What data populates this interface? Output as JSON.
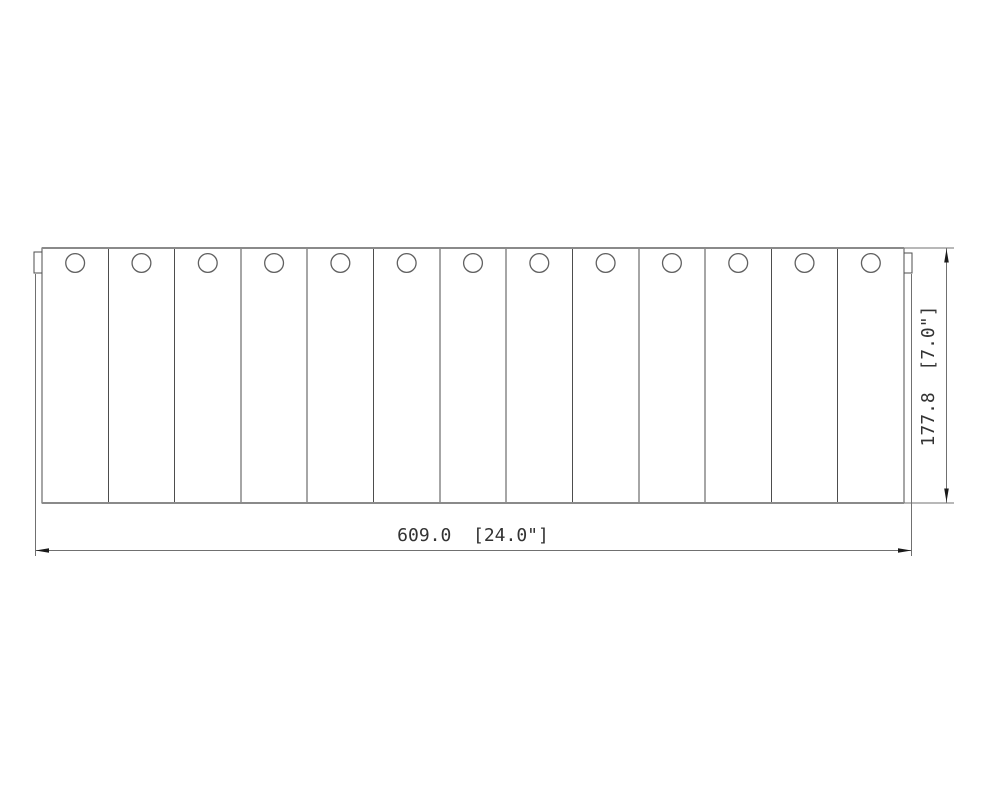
{
  "drawing": {
    "description": "slatted-panel-front-view",
    "panel": {
      "slat_count": 13,
      "hole_count": 13,
      "tab_count": 2
    }
  },
  "dimensions": {
    "width": {
      "label": "609.0  [24.0\"]",
      "mm": 609.0,
      "inches": 24.0
    },
    "height": {
      "label": "177.8  [7.0\"]",
      "mm": 177.8,
      "inches": 7.0
    }
  },
  "colors": {
    "background": "#ffffff",
    "panel_edge": "#8a8a8a",
    "slat_line": "#4d4d4d",
    "hole_line": "#606060",
    "dim_line": "#707070",
    "arrow": "#1a1a1a",
    "dim_text": "#333333"
  }
}
